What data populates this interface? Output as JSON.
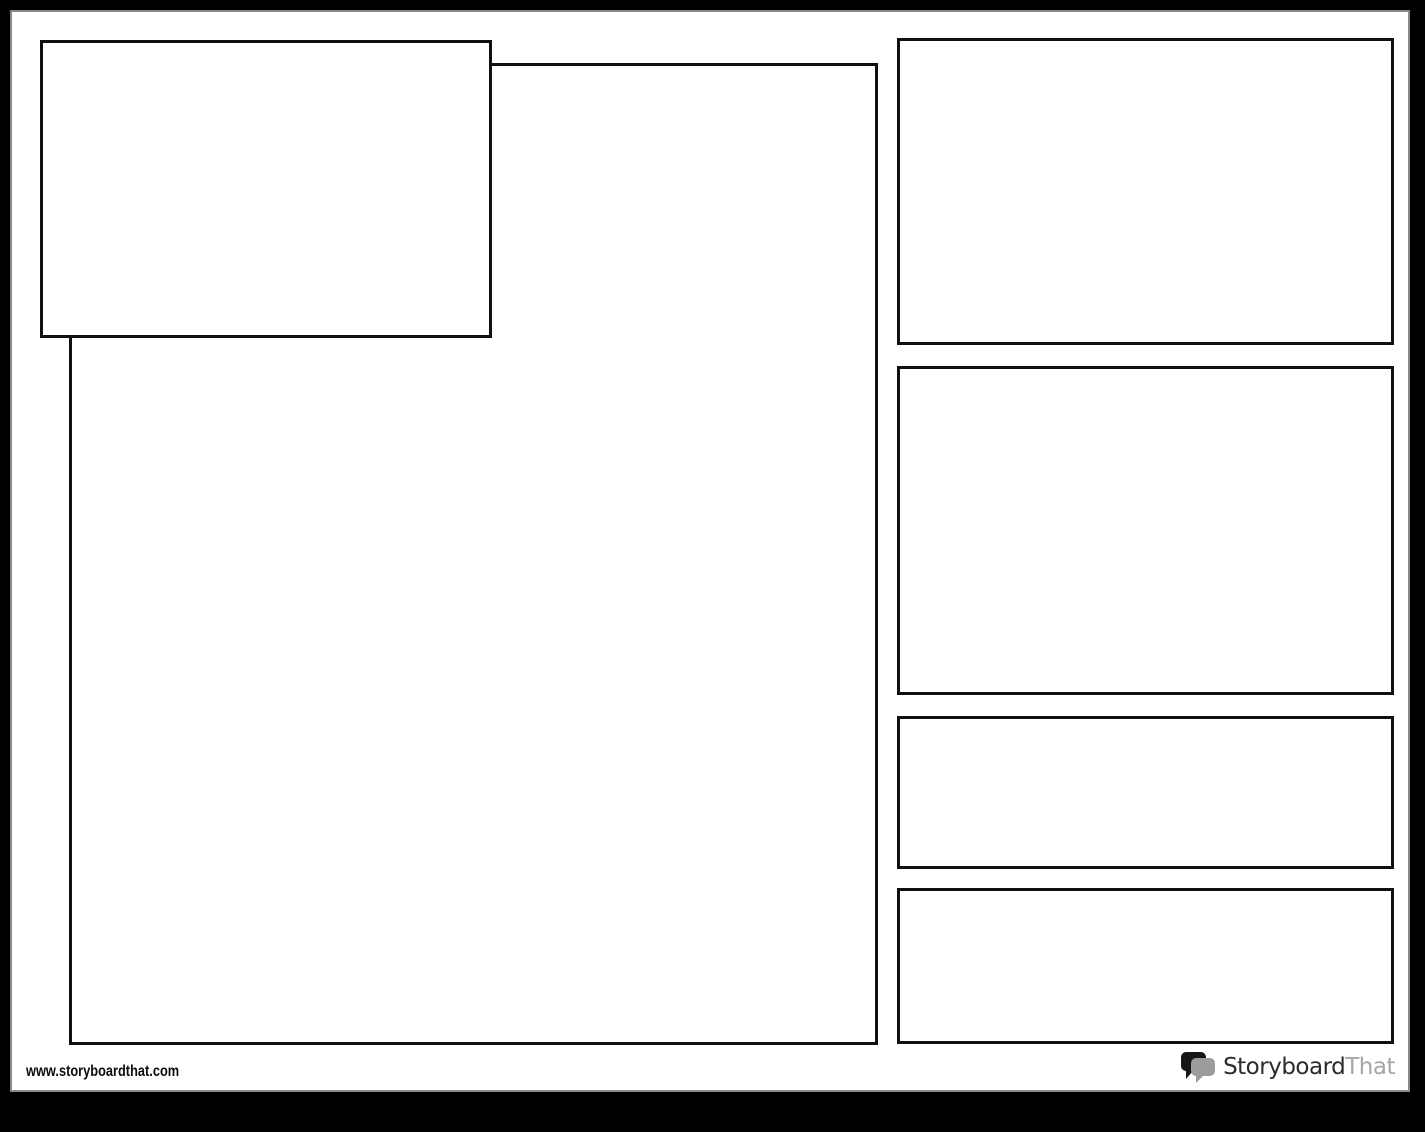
{
  "document": {
    "kind": "blank storyboard graphic-organizer template",
    "cells": [
      {
        "id": "title-cell",
        "content": ""
      },
      {
        "id": "main-cell",
        "content": ""
      },
      {
        "id": "side-cell-1",
        "content": ""
      },
      {
        "id": "side-cell-2",
        "content": ""
      },
      {
        "id": "side-cell-3",
        "content": ""
      },
      {
        "id": "side-cell-4",
        "content": ""
      }
    ]
  },
  "footer": {
    "website": "www.storyboardthat.com"
  },
  "logo": {
    "text_primary": "Storyboard",
    "text_secondary": "That",
    "icon": "speech-bubbles",
    "colors": {
      "primary_text": "#2b2b2e",
      "secondary_text": "#a5a5aa",
      "bubble_back": "#161616",
      "bubble_front": "#9c9c9f"
    }
  },
  "colors": {
    "frame": "#000000",
    "sheet": "#ffffff",
    "sheet_edge": "#8a8a8a",
    "cell_border": "#101010"
  }
}
